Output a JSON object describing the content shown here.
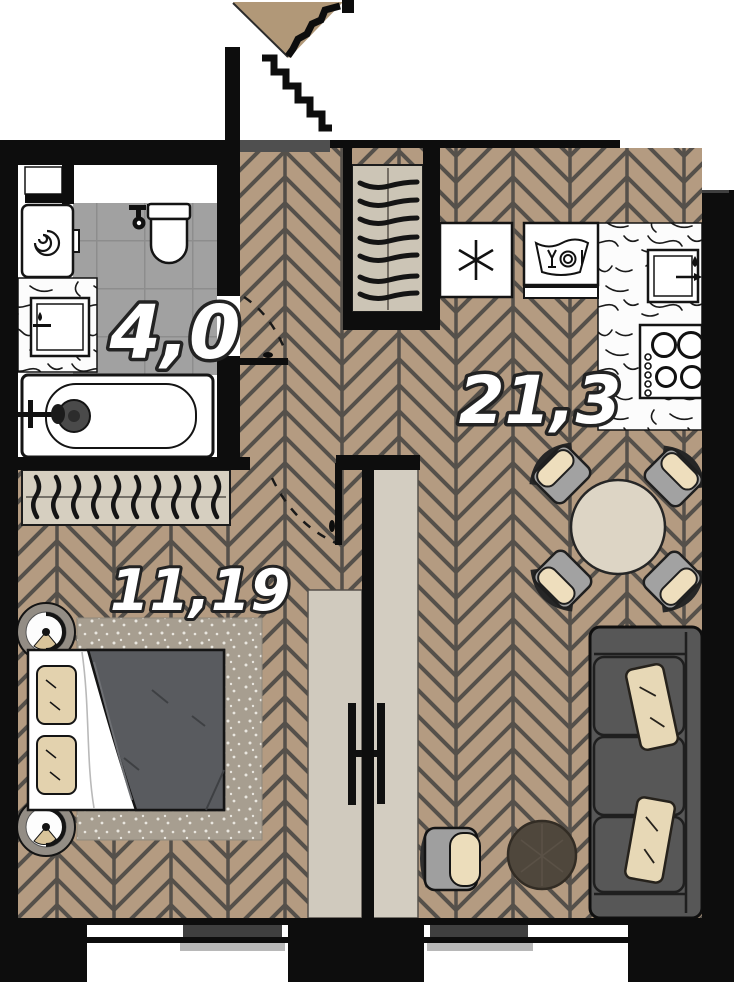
{
  "floorplan": {
    "title": "apartment-floor-plan",
    "rooms": [
      {
        "id": "bathroom",
        "area_label": "4,0"
      },
      {
        "id": "kitchen-living-room",
        "area_label": "21,3"
      },
      {
        "id": "bedroom",
        "area_label": "11,19"
      }
    ],
    "icons": {
      "entrance-arrow": "filled triangle pointing into apartment over door opening",
      "freezer-asterisk": "snowflake asterisk on fridge",
      "dishwasher-glyph": "basin with glass, plate and fork",
      "stove-burners": "four burner circles with knob dots",
      "washer-drum-spiral": "spiral drum on washing machine",
      "hanger-rows": "coat hangers in entry closet and bedroom wardrobe",
      "door-swing-dashes": "dashed quarter-circle door swing arcs",
      "tv-mount": "flat TV bars on both sides of partition wall",
      "window-sill-bars": "dark and light sill bars in window openings"
    },
    "colors": {
      "wall": "#0d0d0d",
      "wood_floor": "#b49b81",
      "wood_line": "#55504a",
      "tile_floor": "#a1a1a1",
      "closet_bg": "#ccc5b6",
      "panel": "#d2ccc0",
      "sofa": "#575757",
      "cushion": "#e7d8b6",
      "blanket": "#595b5f",
      "rug": "#a79e90",
      "table": "#ddd5c5",
      "entrance_triangle": "#b19878"
    }
  }
}
